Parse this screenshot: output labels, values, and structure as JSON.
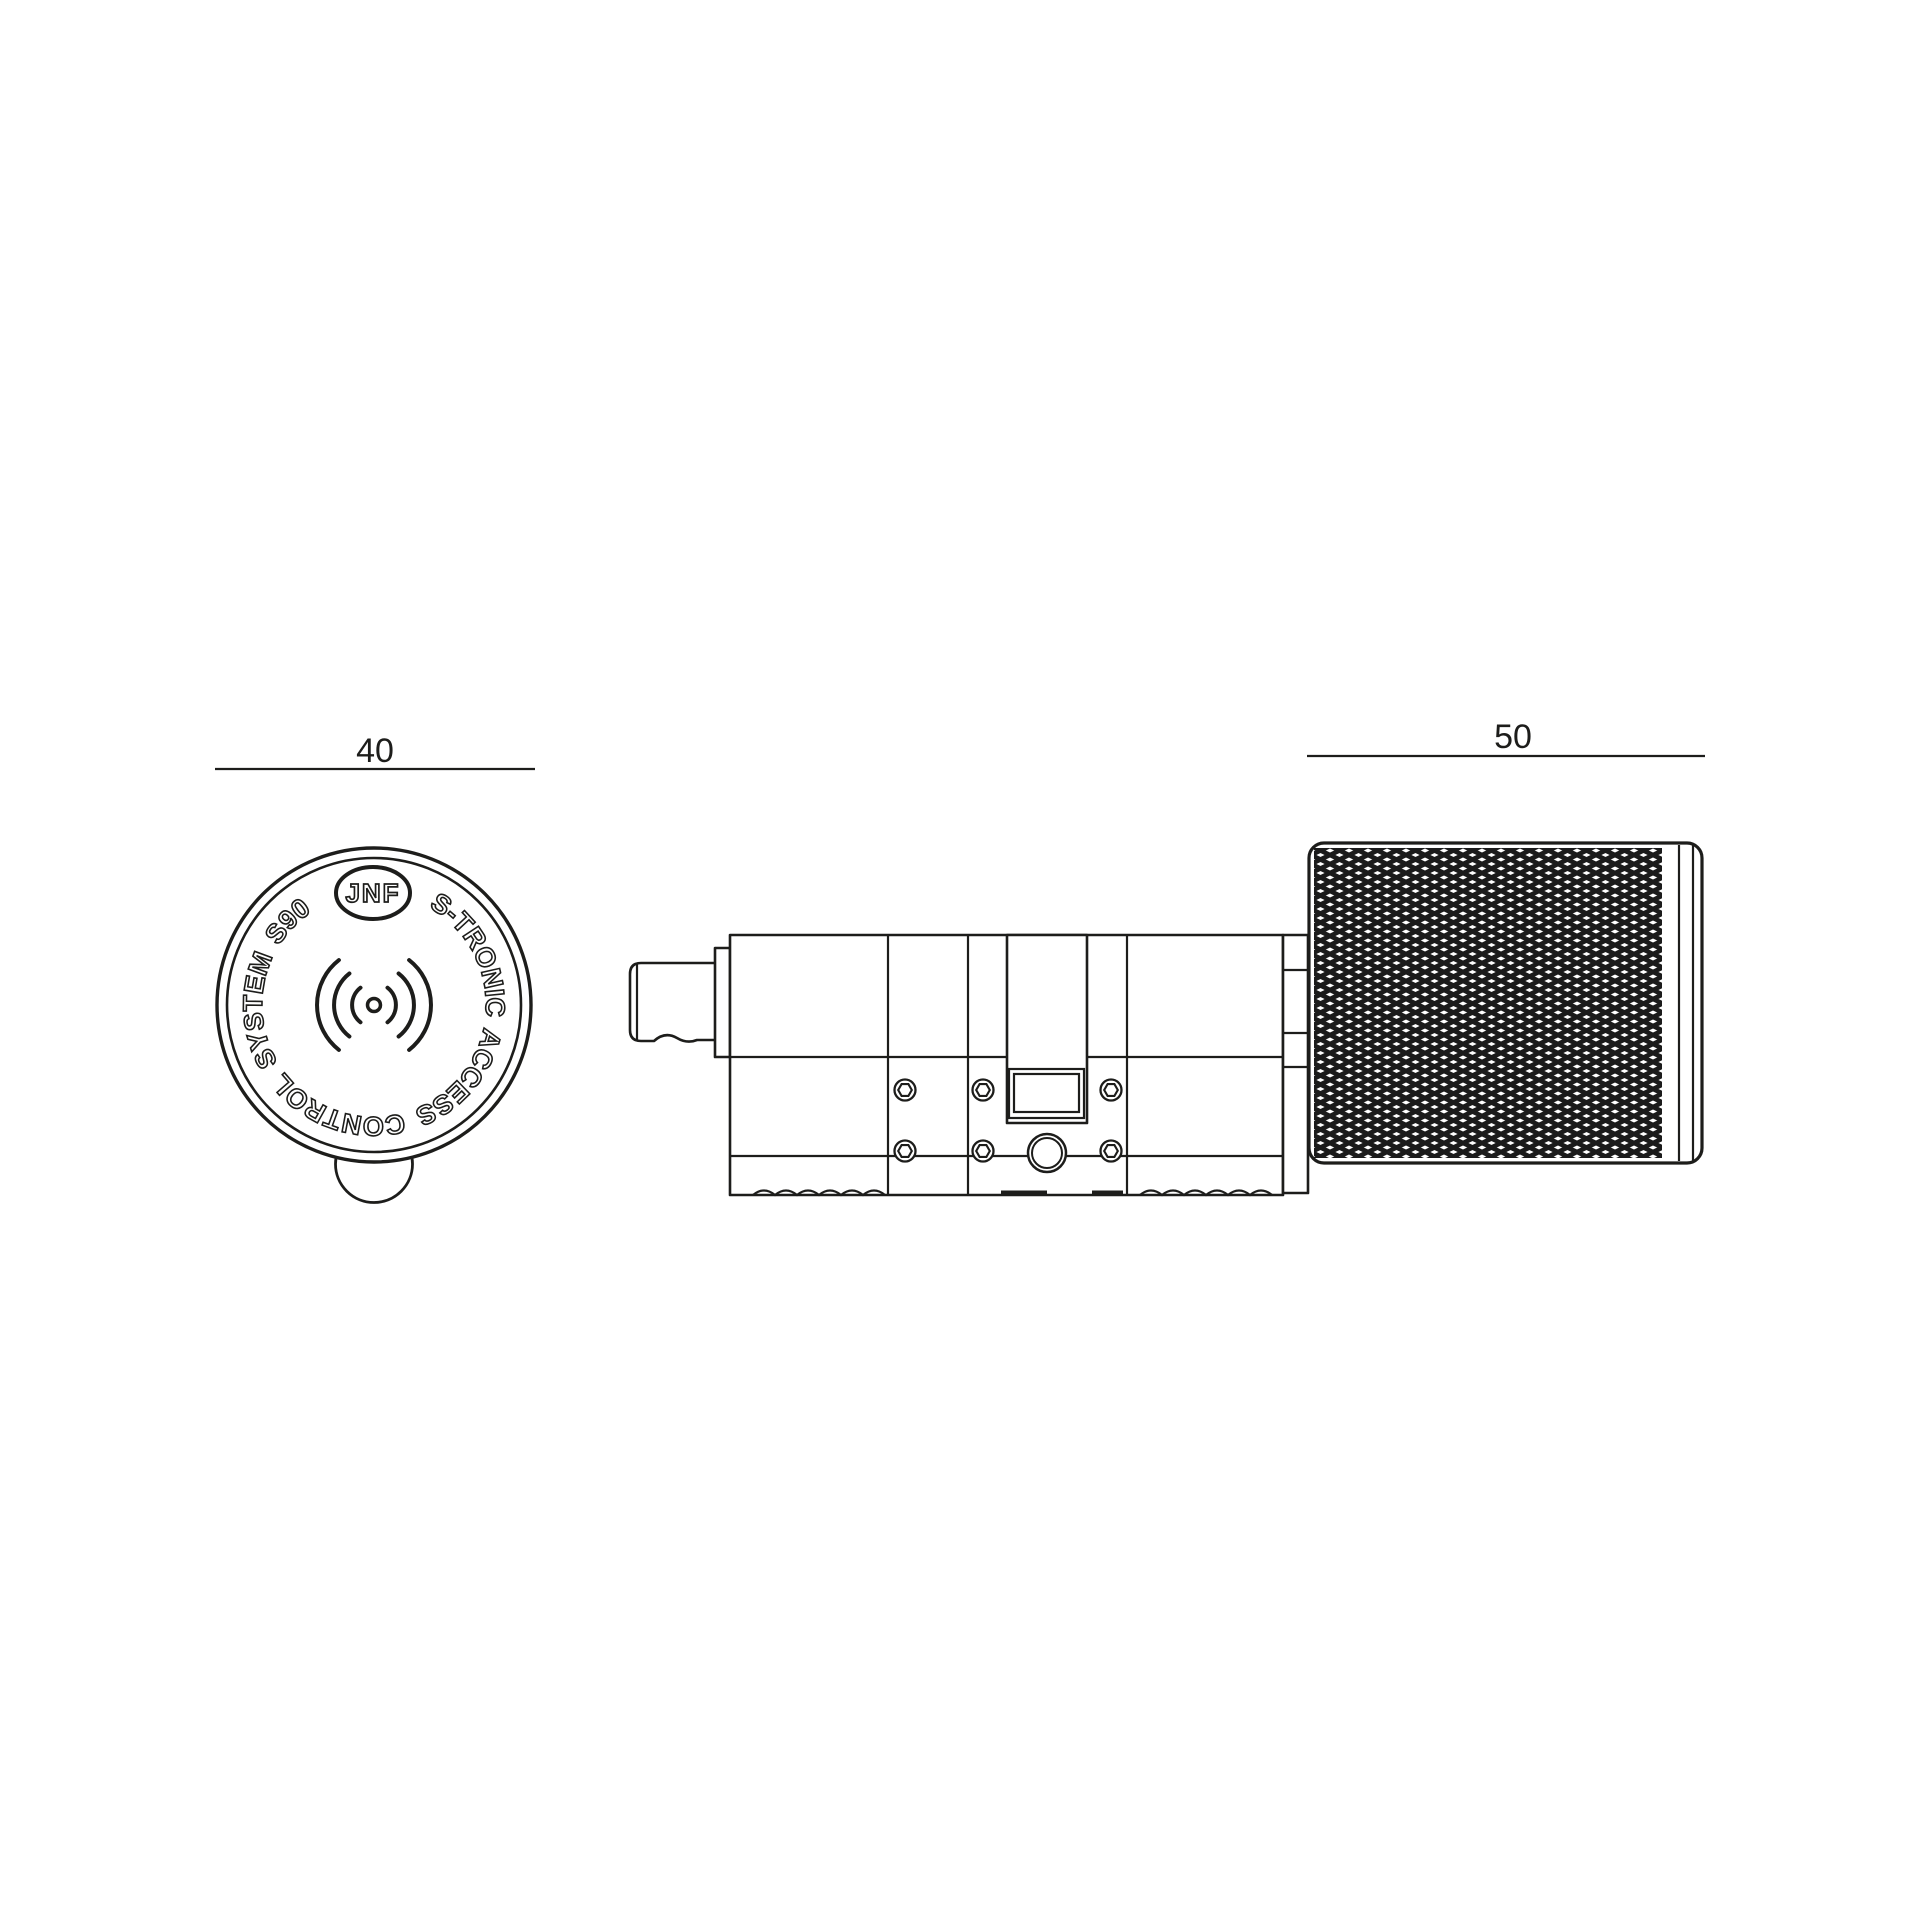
{
  "drawing": {
    "background": "#ffffff",
    "line_color": "#1d1d1b",
    "front_view": {
      "name": "electronic knob face - front view",
      "dimension_label": "40",
      "logo_text": "JNF",
      "ring_text": "S-TRONIC ACCESS CONTROL SYSTEM S90",
      "center_icon": "rfid-signal-icon"
    },
    "side_view": {
      "name": "electronic cylinder with knurled knob - side view",
      "dimension_label": "50"
    }
  }
}
